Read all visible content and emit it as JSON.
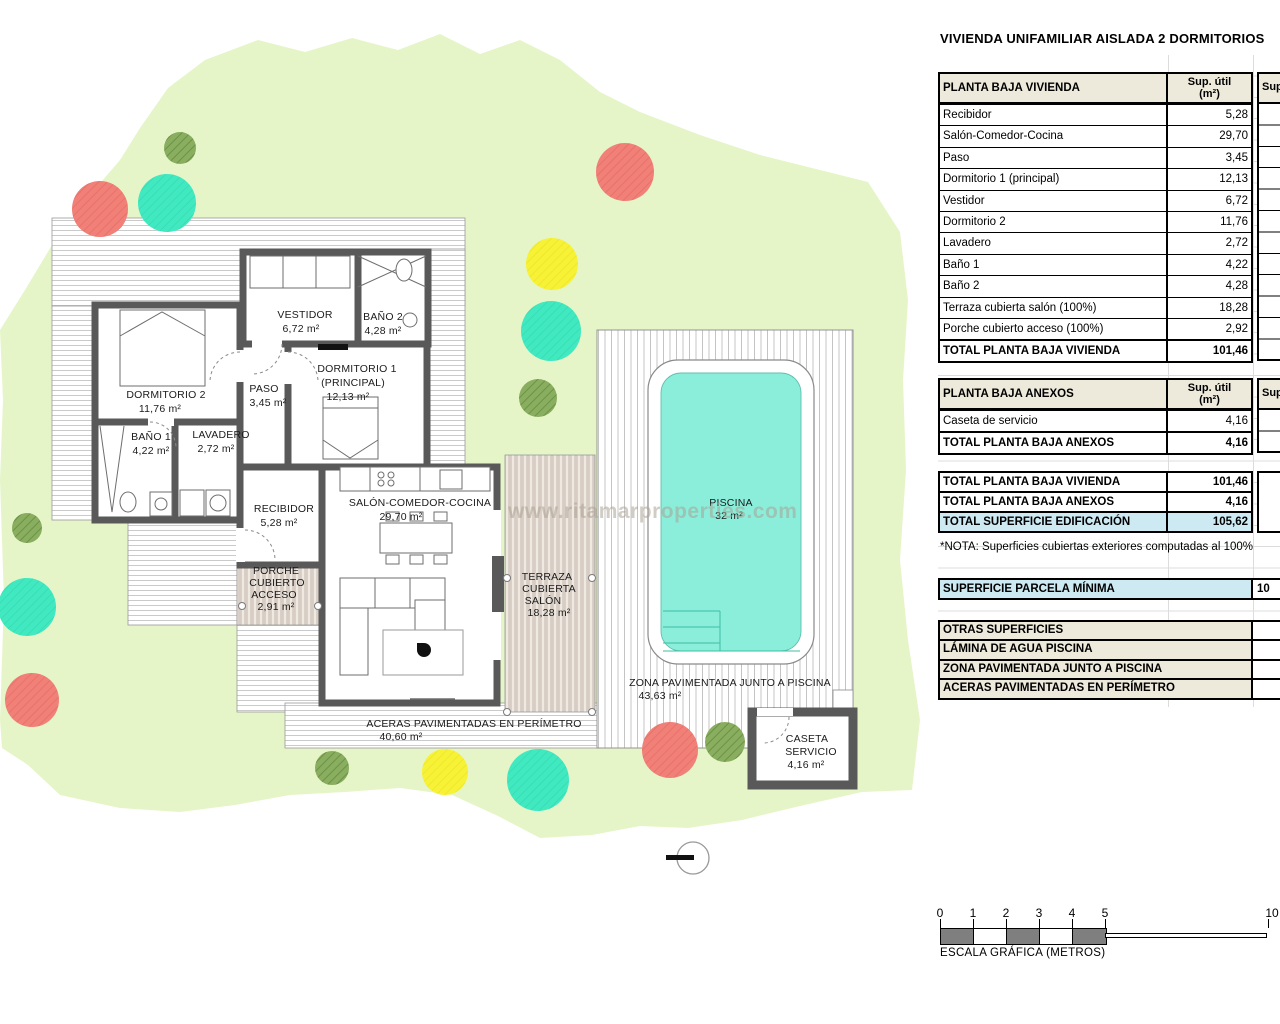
{
  "panel": {
    "title": "VIVIENDA UNIFAMILIAR AISLADA 2 DORMITORIOS",
    "col_header_line1": "Sup. útil",
    "col_header_line2": "(m²)",
    "col_header_cut": "Sup",
    "tables": [
      {
        "header": "PLANTA BAJA VIVIENDA",
        "rows": [
          [
            "Recibidor",
            "5,28"
          ],
          [
            "Salón-Comedor-Cocina",
            "29,70"
          ],
          [
            "Paso",
            "3,45"
          ],
          [
            "Dormitorio 1 (principal)",
            "12,13"
          ],
          [
            "Vestidor",
            "6,72"
          ],
          [
            "Dormitorio 2",
            "11,76"
          ],
          [
            "Lavadero",
            "2,72"
          ],
          [
            "Baño 1",
            "4,22"
          ],
          [
            "Baño 2",
            "4,28"
          ],
          [
            "Terraza cubierta salón (100%)",
            "18,28"
          ],
          [
            "Porche cubierto acceso (100%)",
            "2,92"
          ]
        ],
        "total": [
          "TOTAL PLANTA BAJA VIVIENDA",
          "101,46"
        ]
      },
      {
        "header": "PLANTA BAJA ANEXOS",
        "rows": [
          [
            "Caseta de servicio",
            "4,16"
          ]
        ],
        "total": [
          "TOTAL PLANTA BAJA ANEXOS",
          "4,16"
        ]
      }
    ],
    "summary": [
      {
        "label": "TOTAL PLANTA BAJA VIVIENDA",
        "value": "101,46"
      },
      {
        "label": "TOTAL PLANTA BAJA ANEXOS",
        "value": "4,16"
      },
      {
        "label": "TOTAL SUPERFICIE EDIFICACIÓN",
        "value": "105,62"
      }
    ],
    "note": "*NOTA: Superficies cubiertas exteriores computadas al 100%",
    "parcela": {
      "label": "SUPERFICIE PARCELA MÍNIMA",
      "value": "10"
    },
    "otras": [
      "OTRAS SUPERFICIES",
      "LÁMINA DE AGUA PISCINA",
      "ZONA PAVIMENTADA JUNTO A PISCINA",
      "ACERAS PAVIMENTADAS EN PERÍMETRO"
    ]
  },
  "scalebar": {
    "ticks": [
      "0",
      "1",
      "2",
      "3",
      "4",
      "5"
    ],
    "end_tick": "10",
    "caption": "ESCALA GRÁFICA (METROS)"
  },
  "watermark": "www.ritamarproperties.com",
  "plan": {
    "labels": {
      "vestidor": [
        "VESTIDOR",
        "6,72 m²"
      ],
      "bano2": [
        "BAÑO 2",
        "4,28 m²"
      ],
      "dorm1": [
        "DORMITORIO 1",
        "(PRINCIPAL)",
        "12,13 m²"
      ],
      "dorm2": [
        "DORMITORIO 2",
        "11,76 m²"
      ],
      "paso": [
        "PASO",
        "3,45 m²"
      ],
      "bano1": [
        "BAÑO 1",
        "4,22 m²"
      ],
      "lavadero": [
        "LAVADERO",
        "2,72 m²"
      ],
      "recibidor": [
        "RECIBIDOR",
        "5,28 m²"
      ],
      "salon": [
        "SALÓN-COMEDOR-COCINA",
        "29,70 m²"
      ],
      "porche": [
        "PORCHE",
        "CUBIERTO",
        "ACCESO",
        "2,91 m²"
      ],
      "terraza": [
        "TERRAZA",
        "CUBIERTA",
        "SALÓN",
        "18,28 m²"
      ],
      "piscina": [
        "PISCINA",
        "32 m²"
      ],
      "zona": [
        "ZONA PAVIMENTADA JUNTO A PISCINA",
        "43,63 m²"
      ],
      "caseta": [
        "CASETA",
        "SERVICIO",
        "4,16 m²"
      ],
      "aceras": [
        "ACERAS PAVIMENTADAS EN PERÍMETRO",
        "40,60 m²"
      ]
    },
    "colors": {
      "garden": "#e5f5c8",
      "pool_water": "#8aeedb",
      "tree_red": "#f08078",
      "tree_teal": "#41e9c1",
      "tree_yellow": "#f7f235",
      "tree_olive": "#8aae5f",
      "wall": "#595959",
      "highlight_blue": "#cde9f2",
      "header_beige": "#eeeadb"
    }
  }
}
